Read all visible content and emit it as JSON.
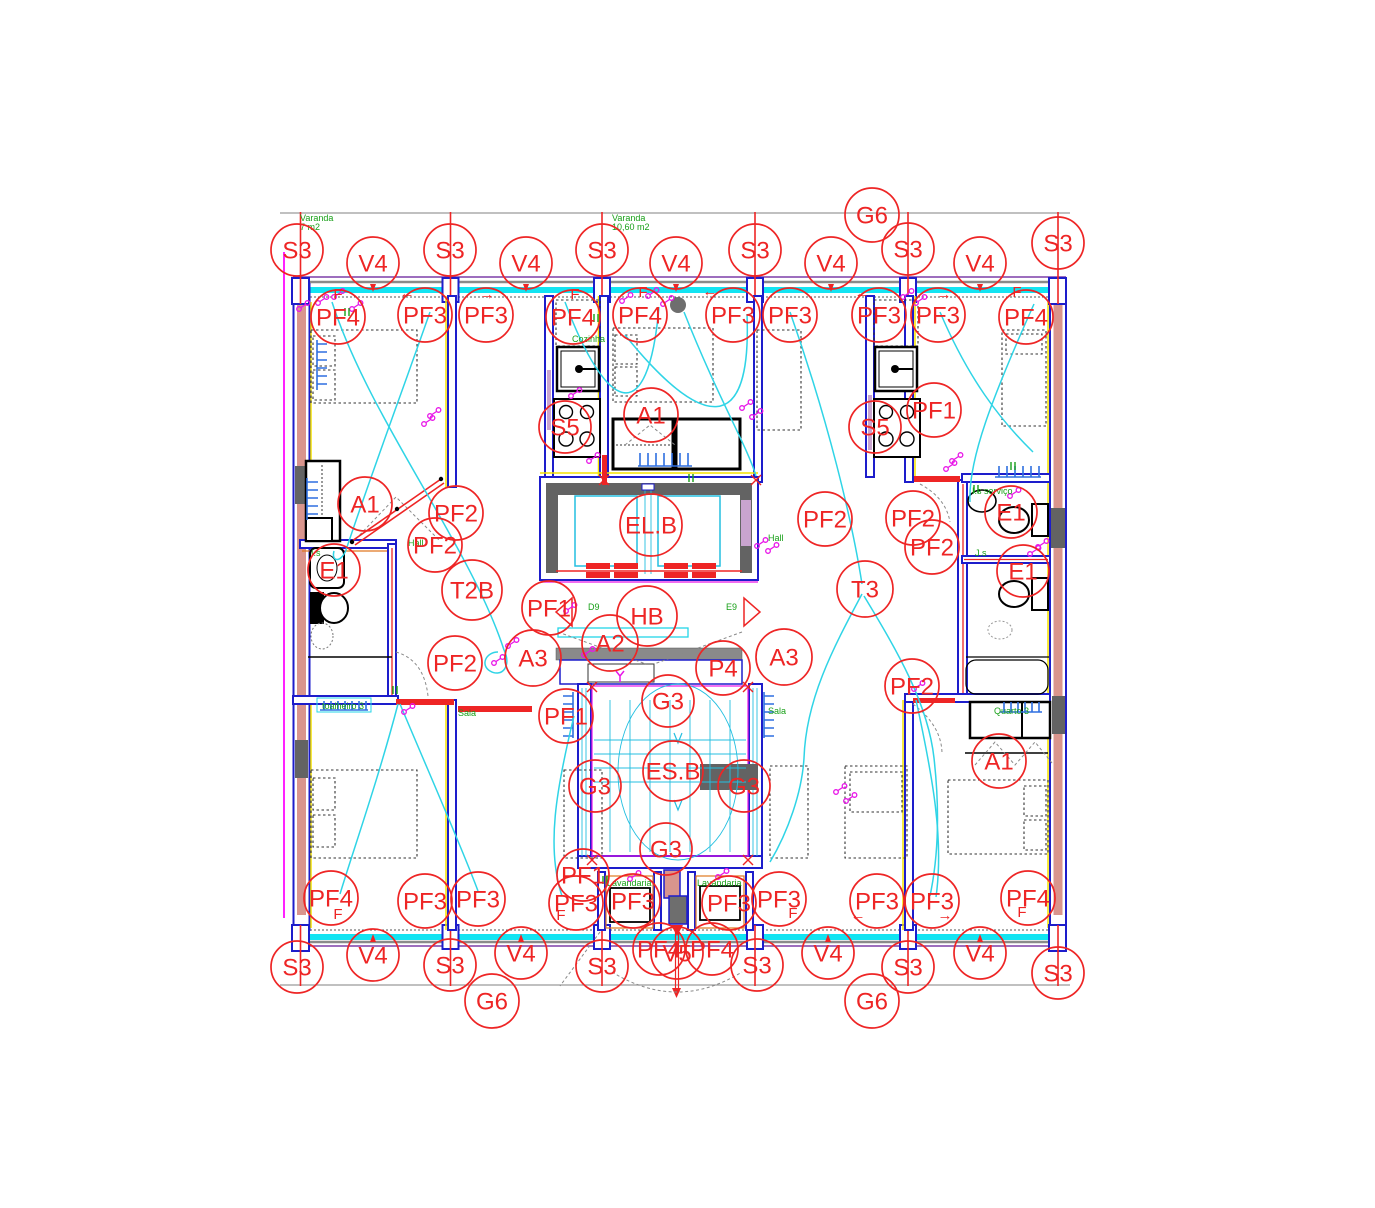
{
  "meta": {
    "kind": "architectural-floor-plan-cad",
    "width": 1375,
    "height": 1208
  },
  "palette": {
    "marker_red": "#ee2525",
    "wall_blue": "#1d1dcb",
    "core_gray": "#636363",
    "wiring_cyan": "#2fd4e6",
    "band_cyan": "#12e4f2",
    "room_green": "#18a018",
    "symbol_magenta": "#e816e8",
    "accent_yellow": "#f5e400",
    "wall_fill_salmon": "#d9958d",
    "lavender": "#c9a4cf",
    "stair_orange": "#e07820"
  },
  "markers": [
    {
      "label": "G6",
      "x": 872,
      "y": 215,
      "r": 27
    },
    {
      "label": "S3",
      "x": 297,
      "y": 250,
      "r": 26
    },
    {
      "label": "V4",
      "x": 373,
      "y": 263,
      "r": 26
    },
    {
      "label": "S3",
      "x": 450,
      "y": 250,
      "r": 26
    },
    {
      "label": "V4",
      "x": 526,
      "y": 263,
      "r": 26
    },
    {
      "label": "S3",
      "x": 602,
      "y": 250,
      "r": 26
    },
    {
      "label": "V4",
      "x": 676,
      "y": 263,
      "r": 26
    },
    {
      "label": "S3",
      "x": 755,
      "y": 250,
      "r": 26
    },
    {
      "label": "V4",
      "x": 831,
      "y": 263,
      "r": 26
    },
    {
      "label": "S3",
      "x": 908,
      "y": 249,
      "r": 26
    },
    {
      "label": "V4",
      "x": 980,
      "y": 263,
      "r": 26
    },
    {
      "label": "S3",
      "x": 1058,
      "y": 243,
      "r": 26
    },
    {
      "label": "PF4",
      "x": 338,
      "y": 317,
      "r": 27
    },
    {
      "label": "PF3",
      "x": 425,
      "y": 315,
      "r": 27
    },
    {
      "label": "PF3",
      "x": 486,
      "y": 315,
      "r": 27
    },
    {
      "label": "PF4",
      "x": 573,
      "y": 317,
      "r": 27
    },
    {
      "label": "PF4",
      "x": 640,
      "y": 315,
      "r": 27
    },
    {
      "label": "PF3",
      "x": 733,
      "y": 315,
      "r": 27
    },
    {
      "label": "PF3",
      "x": 790,
      "y": 315,
      "r": 27
    },
    {
      "label": "PF3",
      "x": 879,
      "y": 315,
      "r": 27
    },
    {
      "label": "PF3",
      "x": 938,
      "y": 315,
      "r": 27
    },
    {
      "label": "PF4",
      "x": 1026,
      "y": 317,
      "r": 27
    },
    {
      "label": "S5",
      "x": 565,
      "y": 427,
      "r": 26
    },
    {
      "label": "A1",
      "x": 651,
      "y": 415,
      "r": 27
    },
    {
      "label": "S5",
      "x": 875,
      "y": 427,
      "r": 26
    },
    {
      "label": "PF1",
      "x": 934,
      "y": 410,
      "r": 27
    },
    {
      "label": "A1",
      "x": 365,
      "y": 504,
      "r": 27
    },
    {
      "label": "PF2",
      "x": 456,
      "y": 513,
      "r": 27
    },
    {
      "label": "PF2",
      "x": 435,
      "y": 545,
      "r": 27
    },
    {
      "label": "EL.B",
      "x": 651,
      "y": 525,
      "r": 31
    },
    {
      "label": "PF2",
      "x": 825,
      "y": 519,
      "r": 27
    },
    {
      "label": "PF2",
      "x": 913,
      "y": 518,
      "r": 27
    },
    {
      "label": "PF2",
      "x": 932,
      "y": 547,
      "r": 27
    },
    {
      "label": "E1",
      "x": 1011,
      "y": 512,
      "r": 26
    },
    {
      "label": "E1",
      "x": 334,
      "y": 570,
      "r": 26
    },
    {
      "label": "T2B",
      "x": 472,
      "y": 590,
      "r": 30
    },
    {
      "label": "T3",
      "x": 865,
      "y": 589,
      "r": 28
    },
    {
      "label": "E1",
      "x": 1023,
      "y": 571,
      "r": 26
    },
    {
      "label": "PF1",
      "x": 549,
      "y": 608,
      "r": 27
    },
    {
      "label": "HB",
      "x": 647,
      "y": 616,
      "r": 30
    },
    {
      "label": "A2",
      "x": 610,
      "y": 643,
      "r": 28
    },
    {
      "label": "A3",
      "x": 533,
      "y": 658,
      "r": 28
    },
    {
      "label": "P4",
      "x": 723,
      "y": 668,
      "r": 27
    },
    {
      "label": "A3",
      "x": 784,
      "y": 657,
      "r": 28
    },
    {
      "label": "PF2",
      "x": 455,
      "y": 663,
      "r": 27
    },
    {
      "label": "PF2",
      "x": 912,
      "y": 686,
      "r": 27
    },
    {
      "label": "G3",
      "x": 668,
      "y": 701,
      "r": 26
    },
    {
      "label": "PF1",
      "x": 566,
      "y": 716,
      "r": 27
    },
    {
      "label": "G3",
      "x": 595,
      "y": 786,
      "r": 26
    },
    {
      "label": "ES.B",
      "x": 673,
      "y": 771,
      "r": 30
    },
    {
      "label": "G3",
      "x": 744,
      "y": 786,
      "r": 26
    },
    {
      "label": "A1",
      "x": 999,
      "y": 761,
      "r": 27
    },
    {
      "label": "G3",
      "x": 666,
      "y": 849,
      "r": 26
    },
    {
      "label": "PF1",
      "x": 583,
      "y": 875,
      "r": 26
    },
    {
      "label": "PF4",
      "x": 331,
      "y": 898,
      "r": 27
    },
    {
      "label": "PF3",
      "x": 425,
      "y": 901,
      "r": 27
    },
    {
      "label": "PF3",
      "x": 478,
      "y": 899,
      "r": 27
    },
    {
      "label": "PF3",
      "x": 576,
      "y": 903,
      "r": 27
    },
    {
      "label": "PF3",
      "x": 633,
      "y": 901,
      "r": 27
    },
    {
      "label": "PF3",
      "x": 729,
      "y": 903,
      "r": 27
    },
    {
      "label": "PF3",
      "x": 779,
      "y": 899,
      "r": 27
    },
    {
      "label": "PF3",
      "x": 877,
      "y": 901,
      "r": 27
    },
    {
      "label": "PF3",
      "x": 932,
      "y": 901,
      "r": 27
    },
    {
      "label": "PF4",
      "x": 1028,
      "y": 898,
      "r": 27
    },
    {
      "label": "PF4",
      "x": 659,
      "y": 949,
      "r": 26
    },
    {
      "label": "V5",
      "x": 677,
      "y": 953,
      "r": 26
    },
    {
      "label": "PF4",
      "x": 712,
      "y": 949,
      "r": 26
    },
    {
      "label": "S3",
      "x": 297,
      "y": 967,
      "r": 26
    },
    {
      "label": "V4",
      "x": 373,
      "y": 955,
      "r": 26
    },
    {
      "label": "S3",
      "x": 450,
      "y": 965,
      "r": 26
    },
    {
      "label": "V4",
      "x": 521,
      "y": 953,
      "r": 26
    },
    {
      "label": "S3",
      "x": 602,
      "y": 966,
      "r": 26
    },
    {
      "label": "S3",
      "x": 757,
      "y": 965,
      "r": 26
    },
    {
      "label": "V4",
      "x": 828,
      "y": 953,
      "r": 26
    },
    {
      "label": "S3",
      "x": 908,
      "y": 967,
      "r": 26
    },
    {
      "label": "V4",
      "x": 980,
      "y": 953,
      "r": 26
    },
    {
      "label": "S3",
      "x": 1058,
      "y": 973,
      "r": 26
    },
    {
      "label": "G6",
      "x": 492,
      "y": 1001,
      "r": 27
    },
    {
      "label": "G6",
      "x": 872,
      "y": 1001,
      "r": 27
    }
  ],
  "room_labels": [
    {
      "text": "Varanda",
      "x": 300,
      "y": 221
    },
    {
      "text": "7 m2",
      "x": 300,
      "y": 230
    },
    {
      "text": "Varanda",
      "x": 612,
      "y": 221
    },
    {
      "text": "10,60 m2",
      "x": 612,
      "y": 230
    },
    {
      "text": "Cozinha",
      "x": 572,
      "y": 342
    },
    {
      "text": "Hall",
      "x": 408,
      "y": 546
    },
    {
      "text": "Hall",
      "x": 768,
      "y": 541
    },
    {
      "text": "I.s",
      "x": 311,
      "y": 556
    },
    {
      "text": "D9",
      "x": 588,
      "y": 610
    },
    {
      "text": "E9",
      "x": 726,
      "y": 610
    },
    {
      "text": "Sala",
      "x": 458,
      "y": 716
    },
    {
      "text": "Sala",
      "x": 768,
      "y": 714
    },
    {
      "text": "I.s serviço",
      "x": 972,
      "y": 494
    },
    {
      "text": "J.s",
      "x": 975,
      "y": 556
    },
    {
      "text": "Quarto 3",
      "x": 994,
      "y": 714
    },
    {
      "text": "Lavandaria",
      "x": 607,
      "y": 886
    },
    {
      "text": "Lavandaria",
      "x": 697,
      "y": 886
    },
    {
      "text": "toalheiro 3",
      "x": 322,
      "y": 709
    }
  ],
  "annotations": [
    {
      "text": "F",
      "x": 338,
      "y": 299
    },
    {
      "text": "F",
      "x": 575,
      "y": 299
    },
    {
      "text": "F",
      "x": 643,
      "y": 297
    },
    {
      "text": "F",
      "x": 1017,
      "y": 297
    },
    {
      "text": "F",
      "x": 338,
      "y": 919
    },
    {
      "text": "F",
      "x": 561,
      "y": 920
    },
    {
      "text": "F",
      "x": 793,
      "y": 918
    },
    {
      "text": "F",
      "x": 1022,
      "y": 917
    },
    {
      "text": "←",
      "x": 407,
      "y": 298
    },
    {
      "text": "→",
      "x": 487,
      "y": 299
    },
    {
      "text": "←",
      "x": 710,
      "y": 296
    },
    {
      "text": "←",
      "x": 862,
      "y": 298
    },
    {
      "text": "→",
      "x": 944,
      "y": 299
    },
    {
      "text": "←",
      "x": 858,
      "y": 920
    },
    {
      "text": "→",
      "x": 945,
      "y": 920
    }
  ],
  "symbols": {
    "magenta": [
      [
        318,
        303
      ],
      [
        334,
        297
      ],
      [
        352,
        309
      ],
      [
        430,
        416
      ],
      [
        424,
        424
      ],
      [
        508,
        646
      ],
      [
        494,
        663
      ],
      [
        571,
        396
      ],
      [
        589,
        461
      ],
      [
        566,
        611
      ],
      [
        622,
        301
      ],
      [
        648,
        296
      ],
      [
        663,
        304
      ],
      [
        742,
        408
      ],
      [
        752,
        417
      ],
      [
        757,
        546
      ],
      [
        768,
        551
      ],
      [
        836,
        792
      ],
      [
        846,
        801
      ],
      [
        916,
        303
      ],
      [
        903,
        297
      ],
      [
        952,
        461
      ],
      [
        946,
        469
      ],
      [
        1038,
        547
      ],
      [
        1030,
        554
      ],
      [
        914,
        689
      ],
      [
        630,
        879
      ],
      [
        718,
        877
      ],
      [
        404,
        712
      ],
      [
        584,
        655
      ],
      [
        1010,
        496
      ],
      [
        299,
        309
      ]
    ],
    "green": [
      [
        348,
        312
      ],
      [
        597,
        318
      ],
      [
        692,
        478
      ],
      [
        977,
        489
      ],
      [
        396,
        690
      ],
      [
        606,
        880
      ],
      [
        1014,
        466
      ]
    ],
    "red_x": [
      [
        604,
        480
      ],
      [
        756,
        480
      ],
      [
        592,
        687
      ],
      [
        748,
        687
      ],
      [
        592,
        860
      ],
      [
        748,
        860
      ]
    ]
  }
}
